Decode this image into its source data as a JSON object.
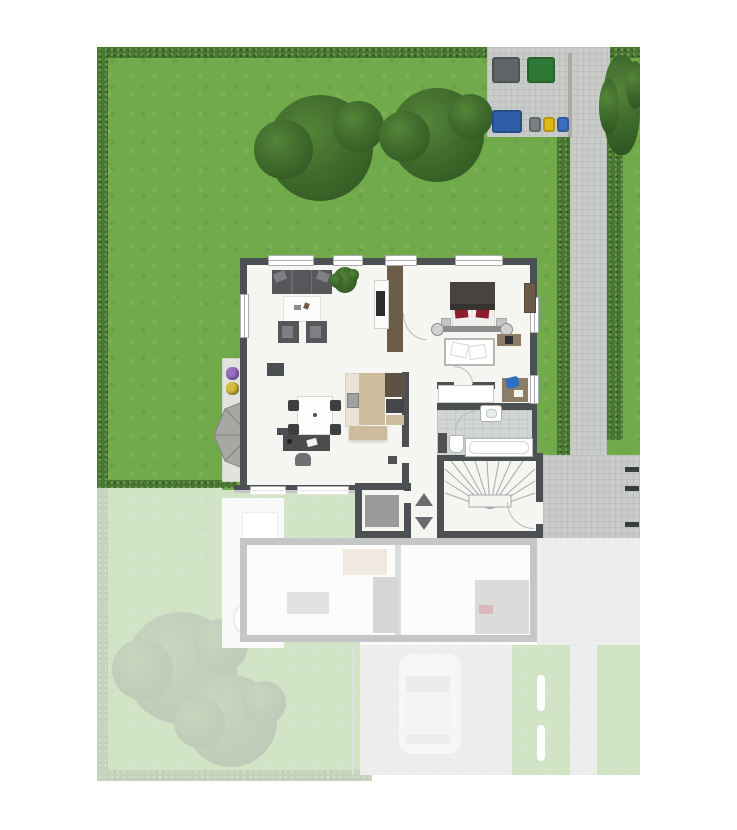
{
  "scene": {
    "type": "top-down 3D floor plan / site plan rendering",
    "vivid_area": "ground-floor unit with garden, terrace, paved path and waste bins",
    "faded_area": "mirrored neighbouring unit, driveway with parked car, shown ghosted",
    "rooms": [
      "living-room",
      "dining-area",
      "kitchen",
      "bedroom",
      "child-bed-area",
      "bathroom",
      "hallway",
      "staircase",
      "entrance",
      "storage-elevator",
      "terrace"
    ],
    "garden_objects": [
      "hedge-border",
      "two-large-trees",
      "bush-by-path",
      "paved-path",
      "bin-station",
      "terrace-parasol",
      "flower-pots"
    ],
    "bins": [
      "large-gray",
      "large-green",
      "large-blue-container",
      "small-gray",
      "small-yellow",
      "small-blue"
    ],
    "faded_objects": [
      "mirrored-unit-floor-plan",
      "round-garden-table",
      "two-trees",
      "car-on-driveway",
      "lawn-strips-with-markings"
    ]
  },
  "palette": {
    "grass": "#71aa4b",
    "hedge": "#47782e",
    "tree-light": "#548538",
    "tree": "#3f6c2d",
    "tree-dark": "#2e521f",
    "paving": "#c9cbc8",
    "wall": "#4d5052",
    "floor": "#f5f5f2",
    "terrace": "#e2e2de",
    "parasol": "#a7a8a3",
    "parasol-line": "#83847f",
    "sofa": "#55575a",
    "sofa-light": "#7d7f82",
    "wood": "#6c5b48",
    "wood-dark": "#5e5246",
    "wood-light": "#8d7d66",
    "kitchen-cream": "#eae3d3",
    "kitchen-tan": "#cdbb9d",
    "appliance": "#454647",
    "bed-dark": "#474340",
    "bed-red": "#8d1f2d",
    "linen": "#f0efec",
    "tile": "#d2d5d6",
    "chair-blue": "#2e6fc4",
    "chair-dark": "#3d3f41",
    "bin-gray": "#5f6468",
    "bin-green": "#2c7a36",
    "bin-blue-large": "#2f5ea7",
    "bin-small-gray": "#7a7f83",
    "bin-yellow": "#e0b818",
    "bin-blue": "#3a6fc0",
    "mark-dark": "#3a3d3f",
    "arrow": "#6a6d70",
    "ghost-gray": "#909294",
    "fade": "rgba(255,255,255,0.68)"
  }
}
